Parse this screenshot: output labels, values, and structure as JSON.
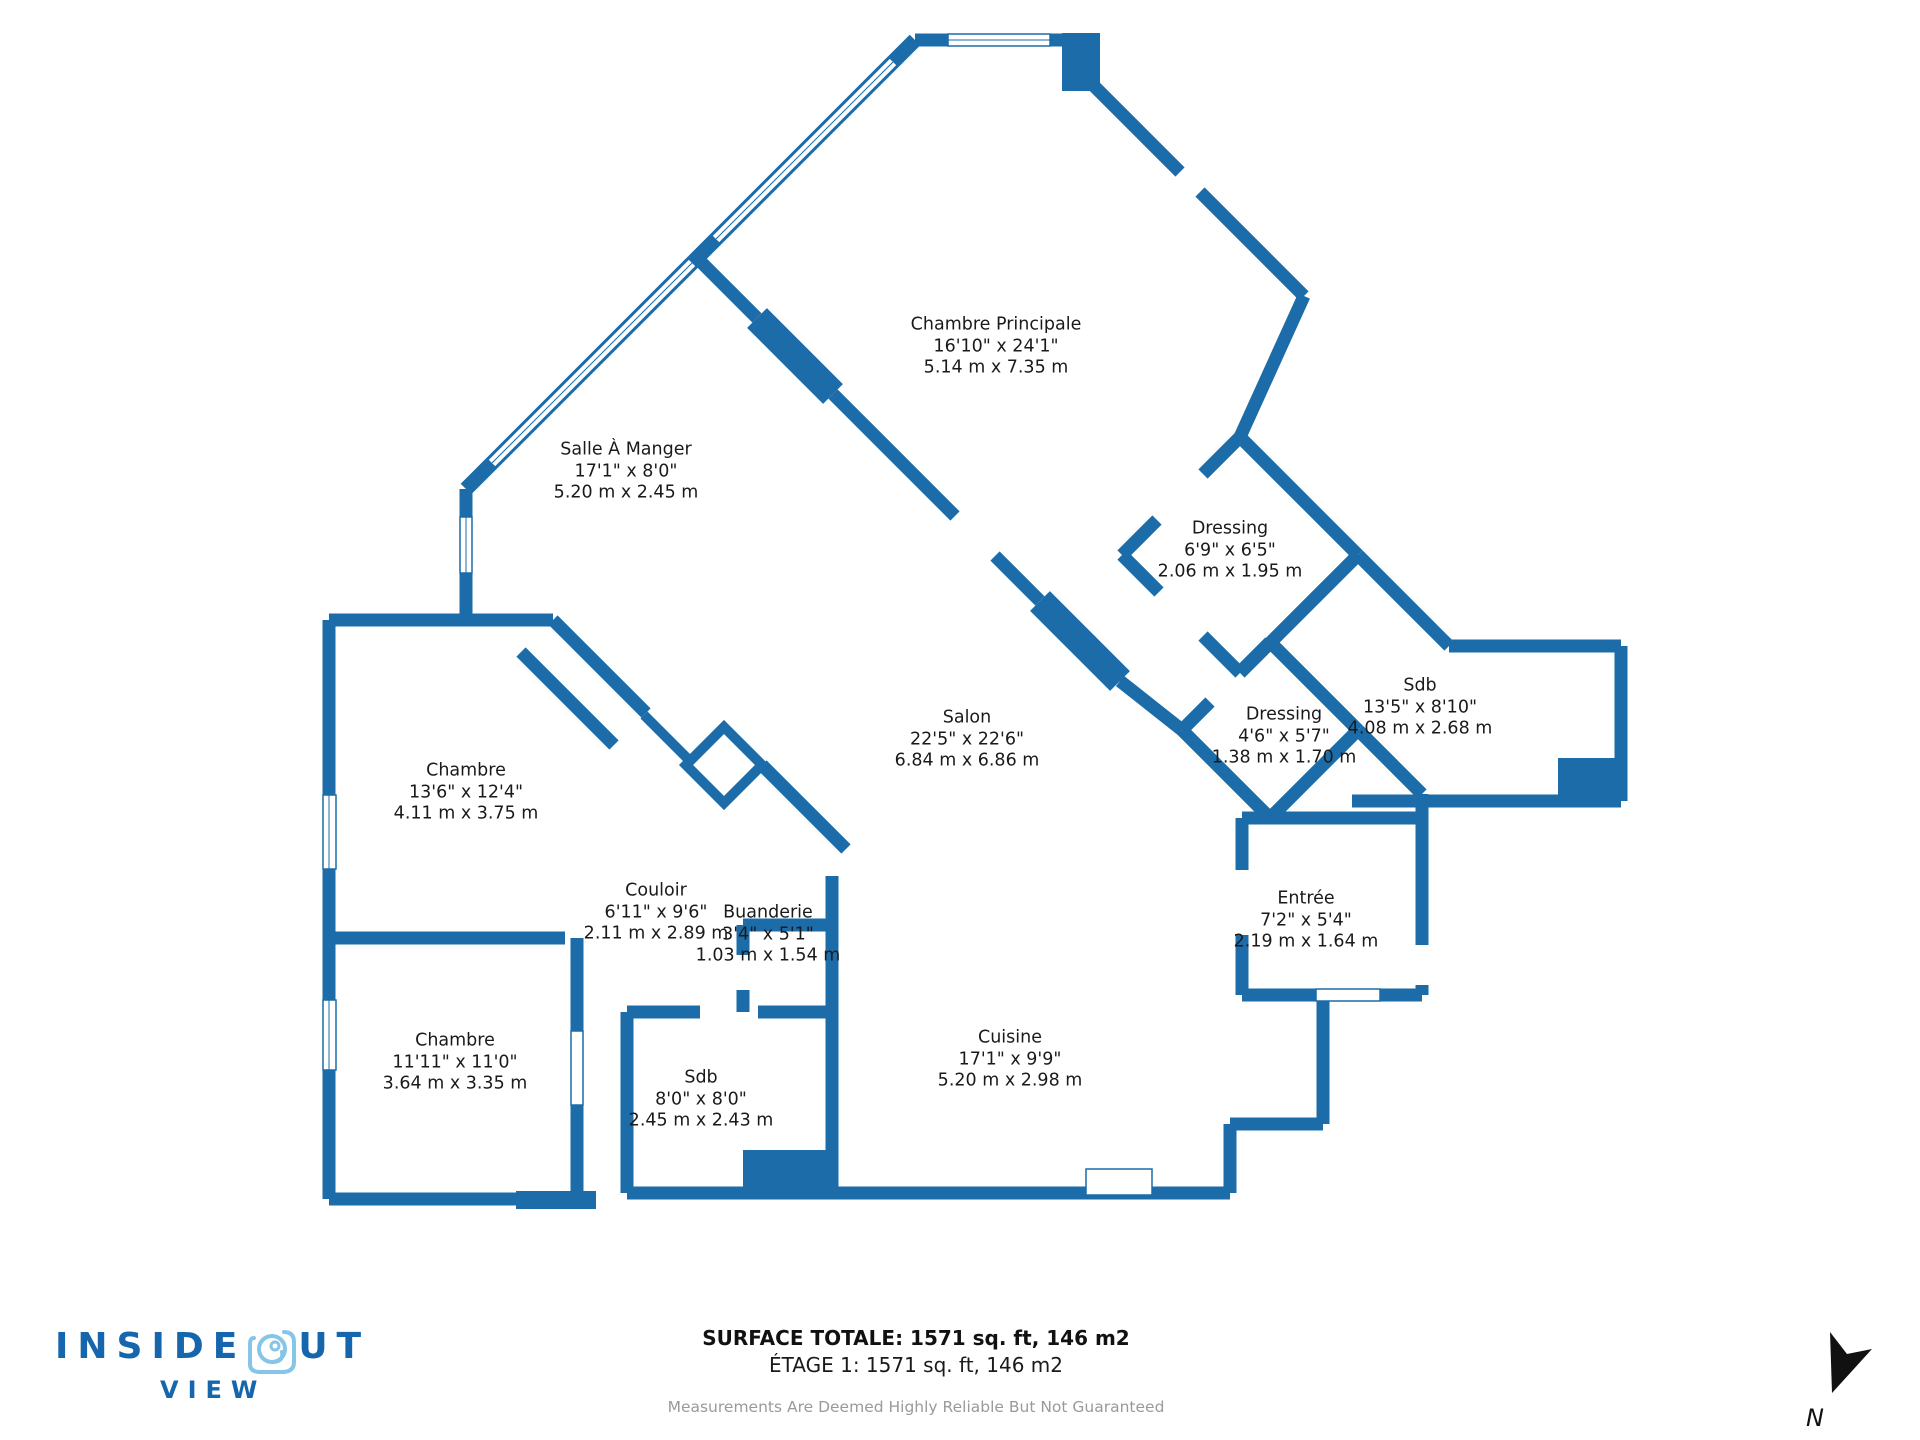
{
  "colors": {
    "wall": "#1B6CA8",
    "window_fill": "#ffffff",
    "label_text": "#1a1a1a",
    "logo_dark": "#1566ac",
    "logo_light": "#85c6e8",
    "footer_gray": "#9a9a9a",
    "compass_black": "#111111"
  },
  "rooms": [
    {
      "name": "Chambre Principale",
      "imperial": "16'10\" x 24'1\"",
      "metric": "5.14 m x 7.35 m"
    },
    {
      "name": "Salle À Manger",
      "imperial": "17'1\" x 8'0\"",
      "metric": "5.20 m x 2.45 m"
    },
    {
      "name": "Dressing",
      "imperial": "6'9\" x 6'5\"",
      "metric": "2.06 m x 1.95 m"
    },
    {
      "name": "Sdb",
      "imperial": "13'5\" x 8'10\"",
      "metric": "4.08 m x 2.68 m"
    },
    {
      "name": "Dressing",
      "imperial": "4'6\" x 5'7\"",
      "metric": "1.38 m x 1.70 m"
    },
    {
      "name": "Salon",
      "imperial": "22'5\" x 22'6\"",
      "metric": "6.84 m x 6.86 m"
    },
    {
      "name": "Chambre",
      "imperial": "13'6\" x 12'4\"",
      "metric": "4.11 m x 3.75 m"
    },
    {
      "name": "Couloir",
      "imperial": "6'11\" x 9'6\"",
      "metric": "2.11 m x 2.89 m"
    },
    {
      "name": "Buanderie",
      "imperial": "3'4\" x 5'1\"",
      "metric": "1.03 m x 1.54 m"
    },
    {
      "name": "Entrée",
      "imperial": "7'2\" x 5'4\"",
      "metric": "2.19 m x 1.64 m"
    },
    {
      "name": "Chambre",
      "imperial": "11'11\" x 11'0\"",
      "metric": "3.64 m x 3.35 m"
    },
    {
      "name": "Sdb",
      "imperial": "8'0\" x 8'0\"",
      "metric": "2.45 m x 2.43 m"
    },
    {
      "name": "Cuisine",
      "imperial": "17'1\" x 9'9\"",
      "metric": "5.20 m x 2.98 m"
    }
  ],
  "footer": {
    "surface_total": "SURFACE TOTALE: 1571 sq. ft, 146 m2",
    "etage": "ÉTAGE 1: 1571 sq. ft, 146 m2",
    "disclaimer": "Measurements Are Deemed Highly Reliable But Not Guaranteed"
  },
  "logo": {
    "part1": "INSIDE",
    "part2": "UT",
    "sub": "VIEW"
  },
  "compass": {
    "label": "N"
  }
}
